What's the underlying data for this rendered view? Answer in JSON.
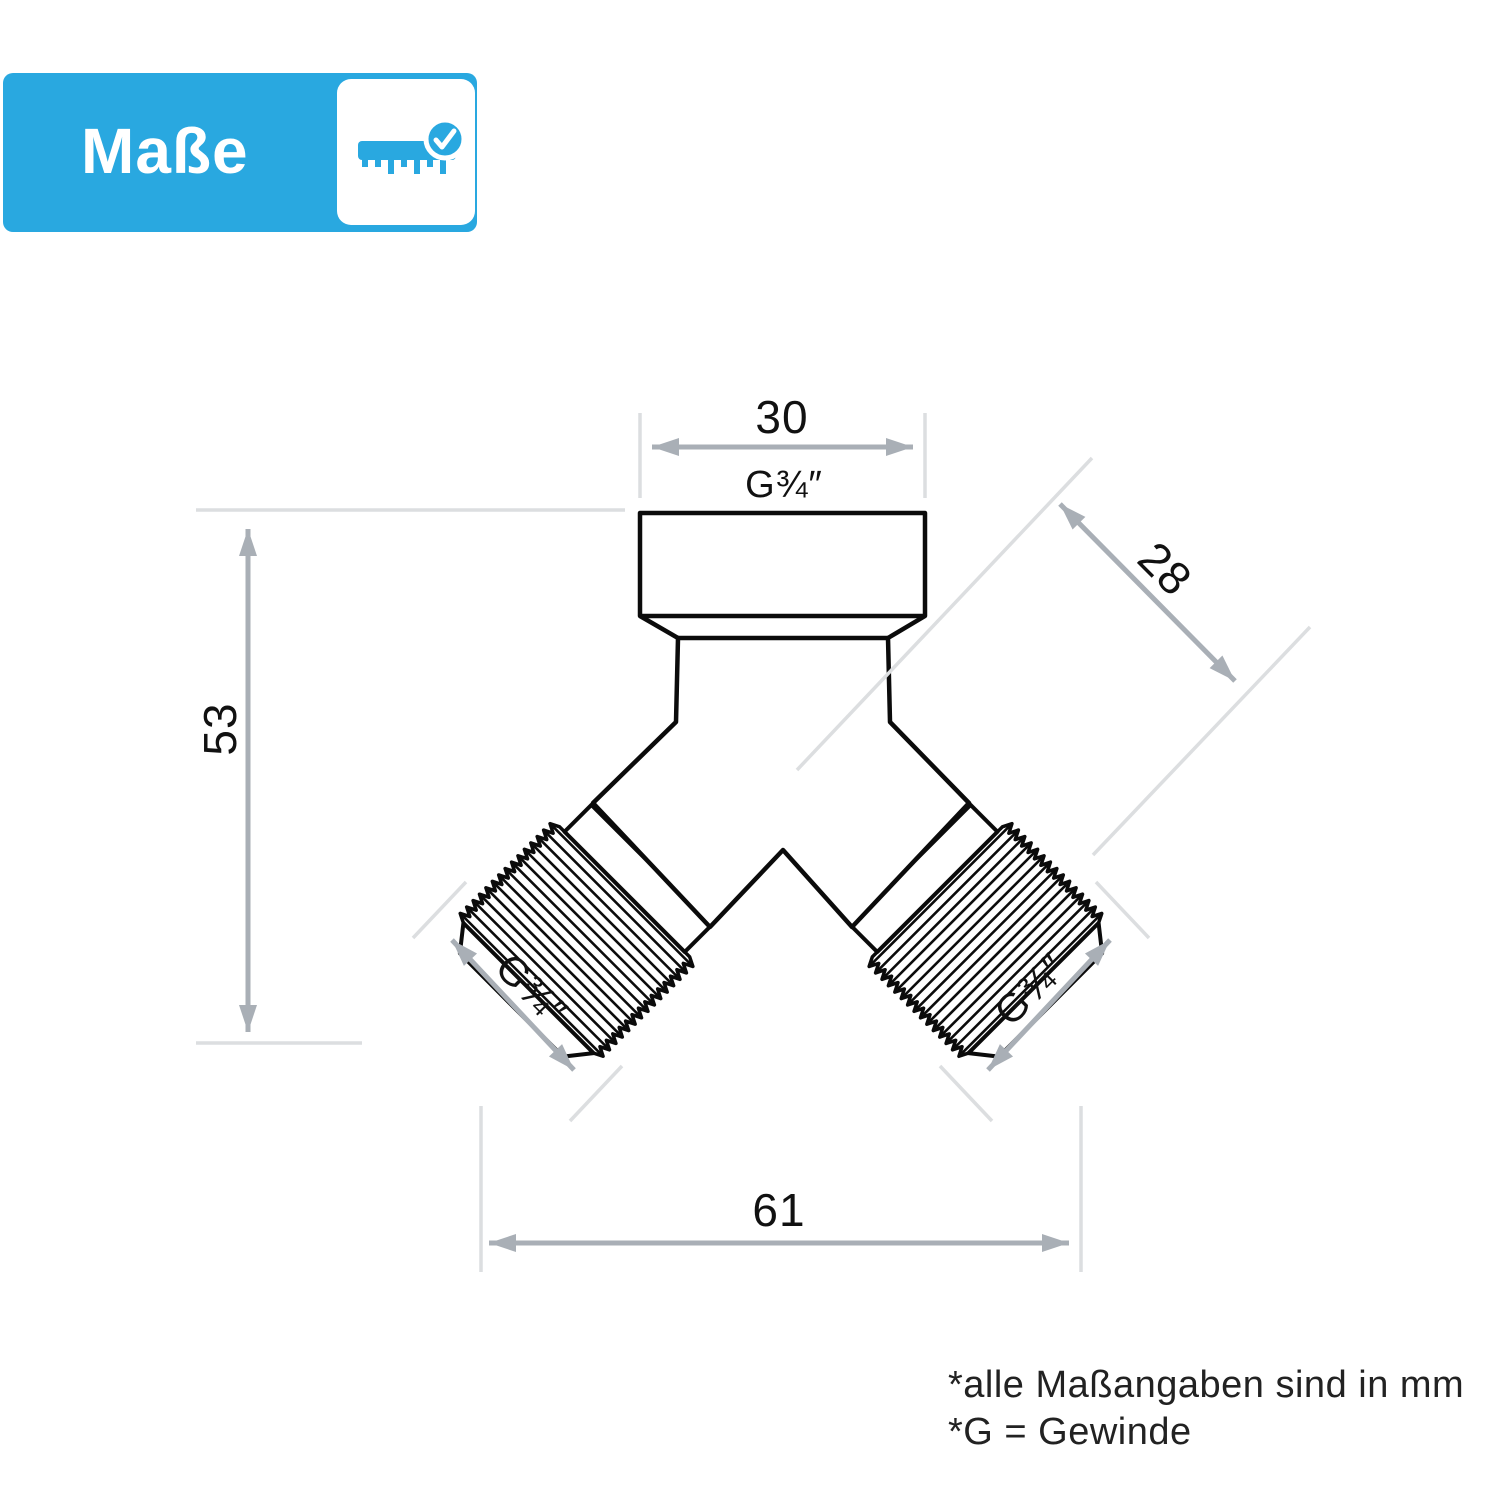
{
  "header": {
    "title": "Maße",
    "icon": "ruler-check-icon"
  },
  "colors": {
    "accent": "#29A8E0",
    "arrow_gray": "#A9AFB6",
    "extension_gray": "#DCDEE0",
    "line_black": "#0B0B0B"
  },
  "diagram": {
    "type": "technical-dimension-drawing",
    "object": "y-splitter-fitting",
    "dimensions": {
      "top_width": "30",
      "top_thread": "G¾″",
      "diagonal_width": "28",
      "height": "53",
      "total_width": "61",
      "left_thread": "G¾″",
      "right_thread": "G¾″"
    }
  },
  "footnotes": {
    "line1": "*alle Maßangaben sind in mm",
    "line2": "*G = Gewinde"
  }
}
